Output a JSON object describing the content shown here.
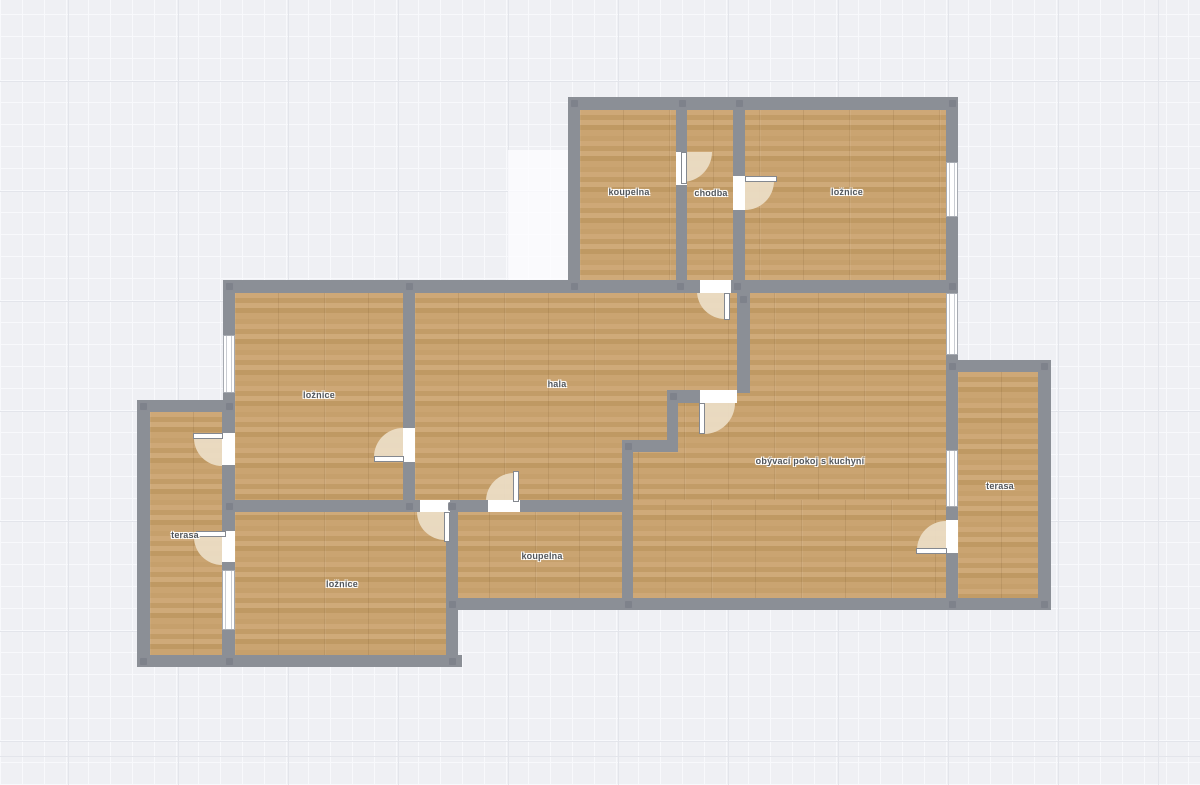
{
  "title": "Floor plan",
  "colors": {
    "background": "#eff0f4",
    "grid_minor": "#f8f9fc",
    "grid_major": "#e3e5eb",
    "wall": "#8b8f96",
    "floor_wood": "#c8a371",
    "door_swing": "#ecdec6",
    "window": "#ffffff",
    "label_text": "#50555b"
  },
  "rooms": [
    {
      "id": "koupelna-top",
      "label": "koupelna"
    },
    {
      "id": "chodba",
      "label": "chodba"
    },
    {
      "id": "loznice-top",
      "label": "ložnice"
    },
    {
      "id": "loznice-left",
      "label": "ložnice"
    },
    {
      "id": "hala",
      "label": "hala"
    },
    {
      "id": "obyvaci-pokoj",
      "label": "obývací pokoj s kuchyní"
    },
    {
      "id": "terasa-right",
      "label": "terasa"
    },
    {
      "id": "terasa-left",
      "label": "terasa"
    },
    {
      "id": "loznice-bottom",
      "label": "ložnice"
    },
    {
      "id": "koupelna-bottom",
      "label": "koupelna"
    }
  ]
}
